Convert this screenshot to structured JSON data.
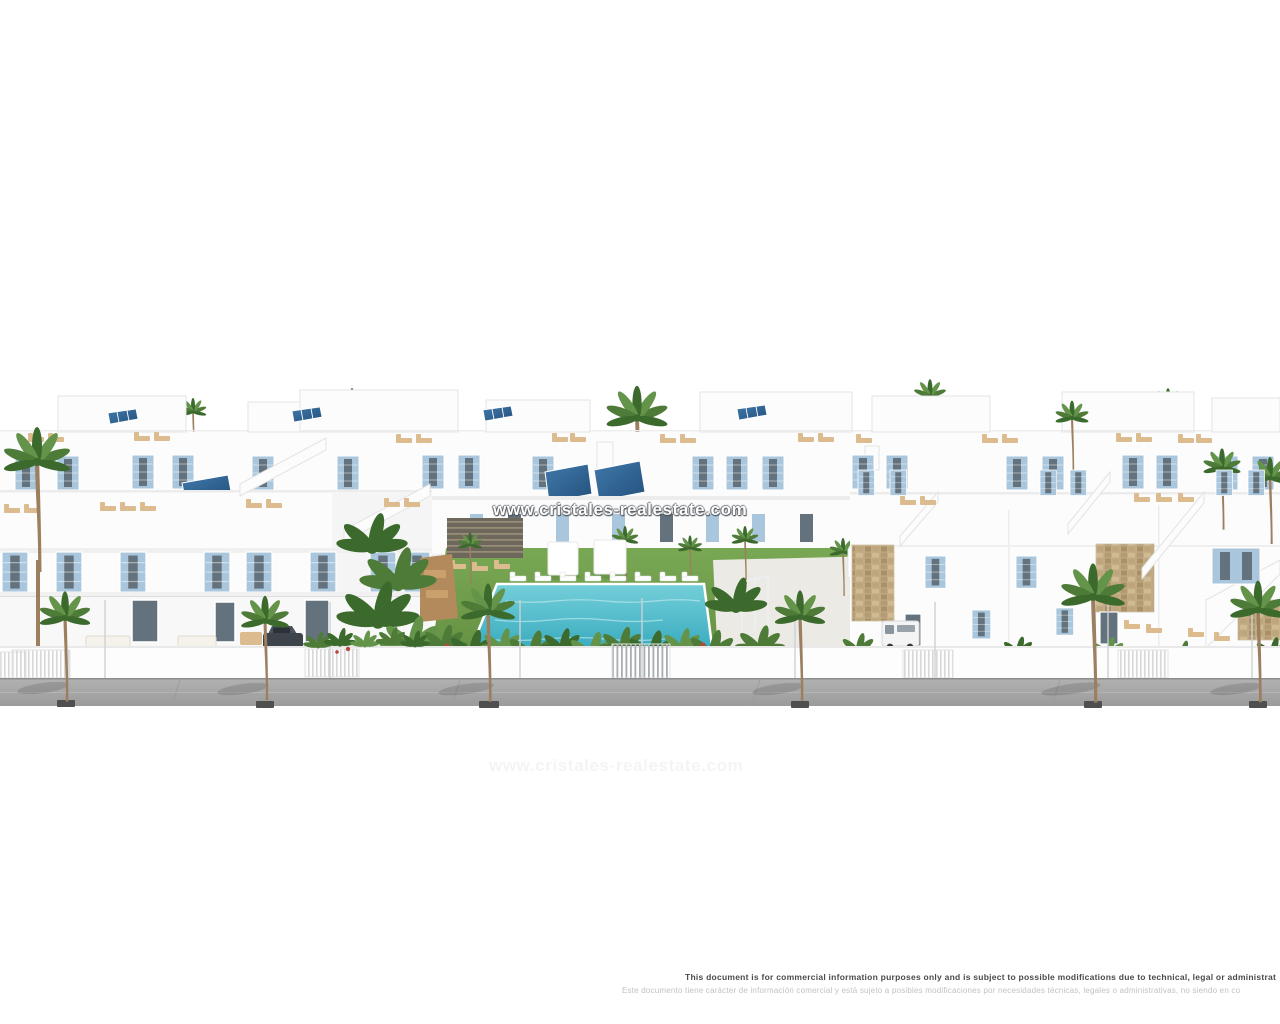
{
  "canvas": {
    "width": 1280,
    "height": 1024,
    "background": "#ffffff"
  },
  "scene": {
    "kind": "architectural-3d-render",
    "subject": "New-build white Mediterranean residential complex: rows of townhouses and villas with sky-blue shutters, roof terraces with sun loungers and solar panels, communal lawn with swimming pool, stone accent walls, palm-lined sidewalk, parked dark car and white van"
  },
  "watermark": {
    "text": "www.cristales-realestate.com"
  },
  "disclaimer": {
    "en": "This document is for commercial information purposes only and is subject to possible modifications due to technical, legal or administrat",
    "es": "Este documento tiene carácter de información comercial y está sujeto a posibles modificaciones por necesidades técnicas, legales o administrativas, no siendo en co"
  },
  "colors": {
    "background": "#ffffff",
    "wall": "#fcfcfc",
    "wallShade": "#ececec",
    "wallLine": "#e3e3e3",
    "shutterBlue": "#a9c6dc",
    "glassDark": "#64727d",
    "solarDark": "#24517c",
    "solarLight": "#4079ab",
    "lawn": "#79a854",
    "lawnDark": "#648f41",
    "palm": "#4e7c38",
    "palmDark": "#3b6a2c",
    "palmLight": "#639449",
    "trunk": "#9b7f5f",
    "poolLight": "#74cfd9",
    "poolDark": "#35a9bd",
    "sand": "#dcbc8e",
    "wood": "#b28a5c",
    "stone": "#c3ac85",
    "street": "#a6a6a6",
    "streetLine": "#8d8d8d",
    "treePad": "#4f4f4f",
    "carDark": "#3e444b",
    "vanWhite": "#f4f4f4",
    "accentRed": "#b5493b",
    "watermark": "#ffffff",
    "disclaimerEn": "#4a4a4a",
    "disclaimerEs": "#c2c2c2"
  }
}
